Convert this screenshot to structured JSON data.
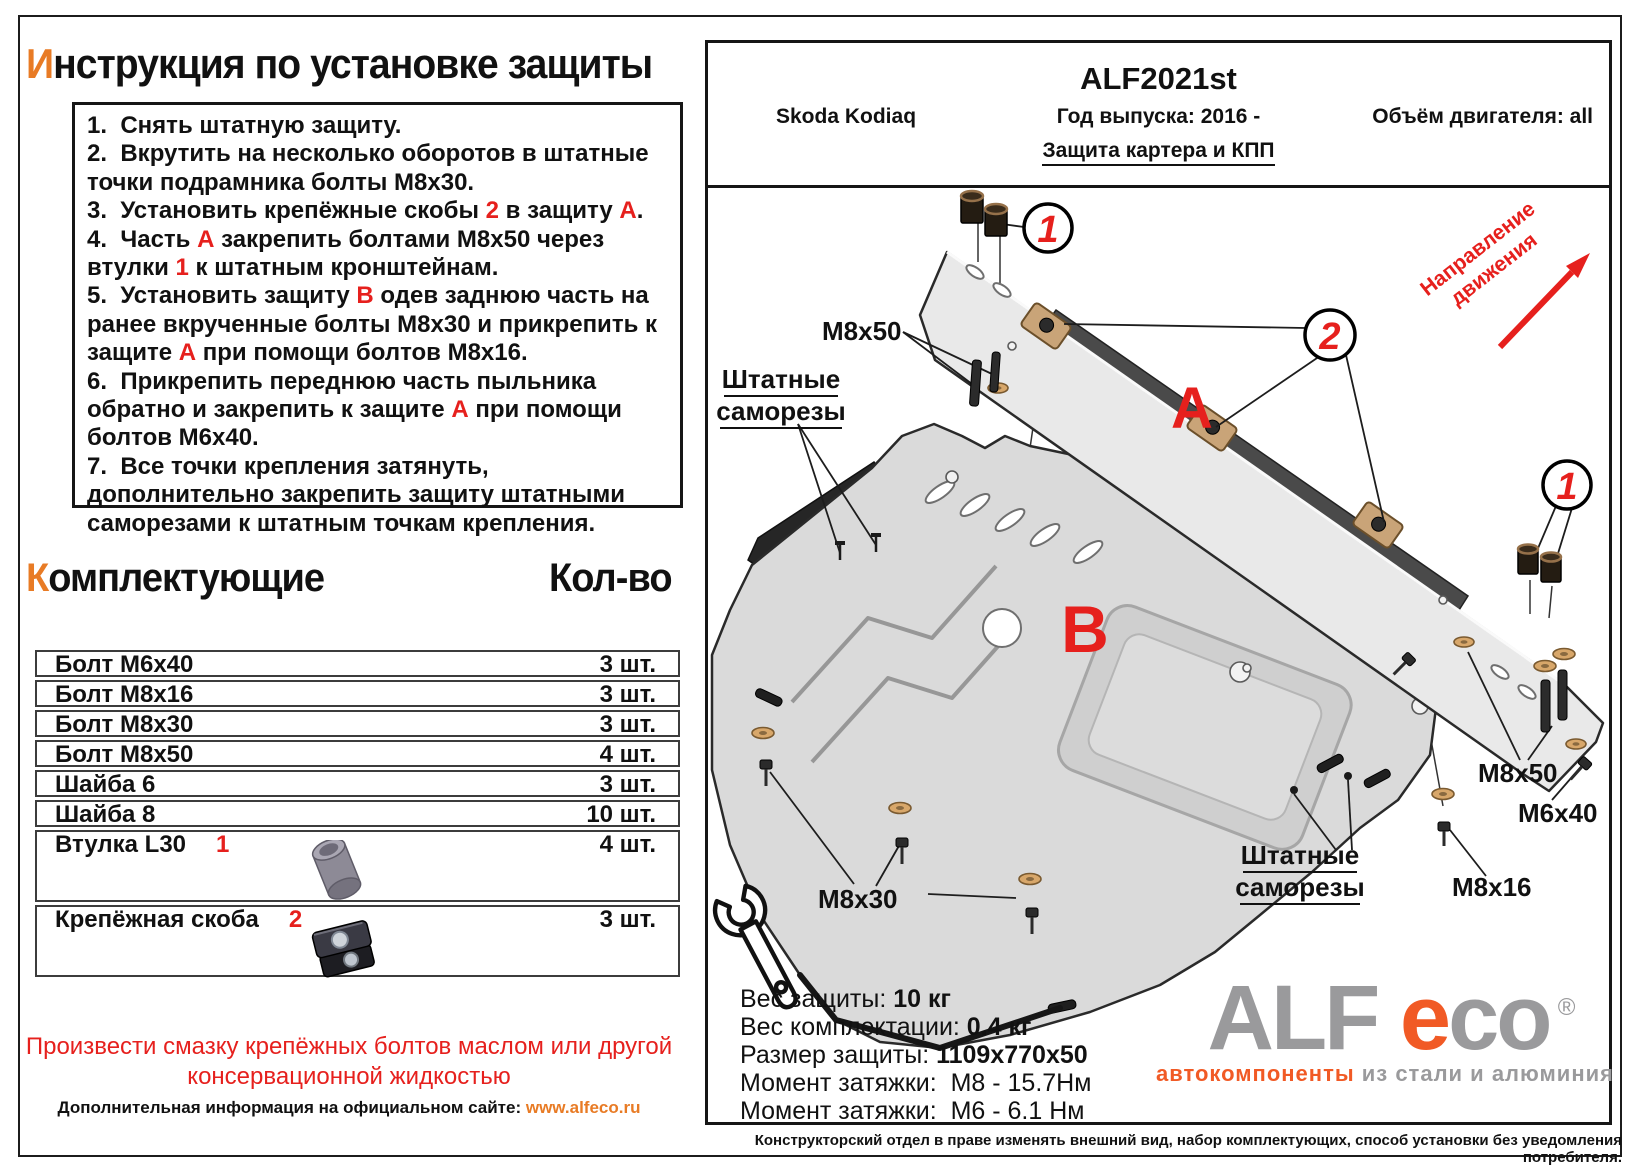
{
  "colors": {
    "accent_orange": "#E87B25",
    "red": "#E6201D",
    "logo_gray": "#9A9A9C",
    "logo_orange": "#F15A25"
  },
  "left": {
    "title": {
      "first_letter": "И",
      "rest": "нструкция по установке защиты"
    },
    "instructions": {
      "items": [
        {
          "parts": [
            {
              "t": "1.  Снять штатную защиту."
            }
          ]
        },
        {
          "parts": [
            {
              "t": "2.  Вкрутить на несколько оборотов в штатные точки подрамника болты М8х30."
            }
          ]
        },
        {
          "parts": [
            {
              "t": "3.  Установить крепёжные скобы "
            },
            {
              "t": "2",
              "red": true
            },
            {
              "t": " в защиту "
            },
            {
              "t": "А",
              "red": true
            },
            {
              "t": "."
            }
          ]
        },
        {
          "parts": [
            {
              "t": "4.  Часть "
            },
            {
              "t": "А",
              "red": true
            },
            {
              "t": " закрепить болтами М8х50 через втулки "
            },
            {
              "t": "1",
              "red": true
            },
            {
              "t": " к штатным кронштейнам."
            }
          ]
        },
        {
          "parts": [
            {
              "t": "5.  Установить защиту "
            },
            {
              "t": "В",
              "red": true
            },
            {
              "t": " одев заднюю часть на ранее вкрученные болты М8х30 и прикрепить к защите "
            },
            {
              "t": "А",
              "red": true
            },
            {
              "t": " при помощи болтов М8х16."
            }
          ]
        },
        {
          "parts": [
            {
              "t": "6.  Прикрепить переднюю часть пыльника обратно и закрепить к защите "
            },
            {
              "t": "А",
              "red": true
            },
            {
              "t": " при помощи болтов М6х40."
            }
          ]
        },
        {
          "parts": [
            {
              "t": "7.  Все точки крепления затянуть, дополнительно закрепить защиту штатными саморезами к штатным точкам крепления."
            }
          ]
        }
      ]
    },
    "components": {
      "title_first": "К",
      "title_rest": "омплектующие",
      "qty_header": "Кол-во",
      "rows": [
        {
          "name": "Болт М6х40",
          "qty": "3 шт."
        },
        {
          "name": "Болт М8х16",
          "qty": "3 шт."
        },
        {
          "name": "Болт М8х30",
          "qty": "3 шт."
        },
        {
          "name": "Болт М8х50",
          "qty": "4 шт."
        },
        {
          "name": "Шайба 6",
          "qty": "3 шт."
        },
        {
          "name": "Шайба 8",
          "qty": "10 шт."
        },
        {
          "name": "Втулка L30",
          "marker": "1",
          "qty": "4 шт.",
          "image": "bushing",
          "tall": true
        },
        {
          "name": "Крепёжная скоба",
          "marker": "2",
          "qty": "3 шт.",
          "image": "clamp",
          "tall": true
        }
      ]
    },
    "warning_line1": "Произвести смазку крепёжных болтов маслом или другой",
    "warning_line2": "консервационной жидкостью",
    "info_prefix": "Дополнительная информация на официальном сайте: ",
    "info_link": "www.alfeco.ru"
  },
  "product": {
    "code": "ALF2021st",
    "car": "Skoda Kodiaq",
    "year_label": "Год выпуска: 2016 -",
    "engine_label": "Объём двигателя: all",
    "protection_label": "Защита картера и КПП"
  },
  "diagram": {
    "labels": {
      "part_a": "А",
      "part_b": "B",
      "callout_1_top": "1",
      "callout_2": "2",
      "callout_1_right": "1",
      "m8x50_left": "M8x50",
      "m8x30": "M8x30",
      "m8x50_right": "M8x50",
      "m6x40": "M6x40",
      "m8x16": "M8x16",
      "factory_screws_left_1": "Штатные",
      "factory_screws_left_2": "саморезы",
      "factory_screws_right_1": "Штатные",
      "factory_screws_right_2": "саморезы",
      "direction_line1": "Направление",
      "direction_line2": "движения"
    }
  },
  "specs": {
    "rows": [
      {
        "label": "Вес защиты: ",
        "value": "10 кг",
        "bold": true
      },
      {
        "label": "Вес комплектации: ",
        "value": "0.4 кг",
        "bold": true
      },
      {
        "label": "Размер защиты: ",
        "value": "1109х770х50",
        "bold": true
      },
      {
        "label": "Момент затяжки:  ",
        "value": "М8 - 15.7Нм",
        "bold": false
      },
      {
        "label": "Момент затяжки:  ",
        "value": "М6 - 6.1 Нм",
        "bold": false
      }
    ]
  },
  "logo": {
    "part1": "ALF",
    "part2": "e",
    "part3": "co",
    "reg": "®",
    "tagline_orange": "автокомпоненты",
    "tagline_gray": " из стали и алюминия"
  },
  "disclaimer": "Конструкторский отдел в праве изменять внешний вид, набор комплектующих, способ установки без уведомления потребителя."
}
